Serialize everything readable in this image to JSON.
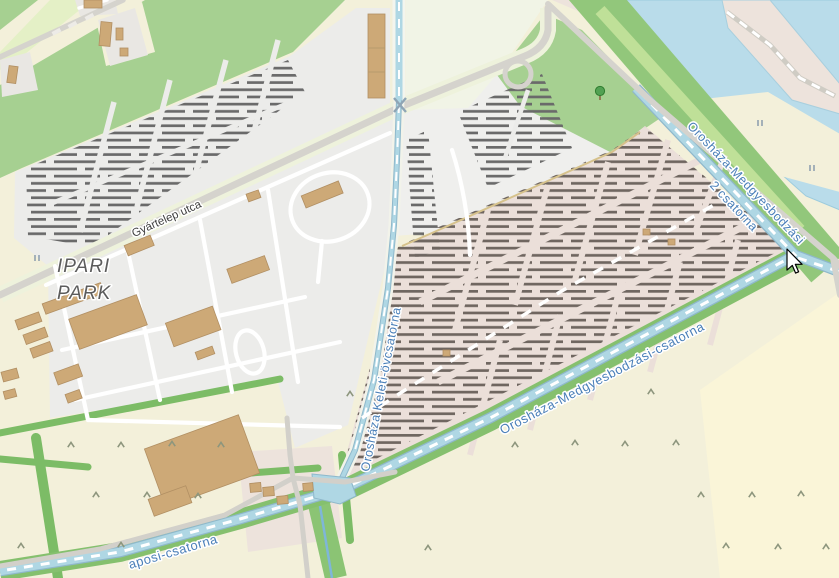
{
  "map": {
    "labels": {
      "place_line1": "IPARI",
      "place_line2": "PARK",
      "street": "Gyártelep utca",
      "canal_keleti": "Orosháza Keleti-övcsatorna",
      "canal_medgyes": "Orosháza-Medgyesbodzási-csatorna",
      "canal_medgyes2_line1": "Orosháza-Medgyesbodzási",
      "canal_medgyes2_line2": "2 csatorna",
      "canal_bottom_left": "aposi-csatorna"
    },
    "icons": {
      "tree": "deciduous-tree-icon",
      "scrub": "scrub-caret-icon",
      "marsh": "marsh-lines-icon",
      "weir": "weir-node-icon",
      "cursor": "mouse-pointer-icon"
    },
    "colors": {
      "farmland": "#F3F0DA",
      "farmland_bright": "#FAF5D8",
      "grass": "#A6D091",
      "band_green": "#92C77B",
      "band_light": "#BFE098",
      "meadow_strip": "#E4F0C6",
      "hedge": "#7CBC66",
      "water": "#B9DCEA",
      "canal": "#AFD7E4",
      "canal_edge": "#8FB8CB",
      "solar_ground": "#ECECEA",
      "whitish": "#EFEFED",
      "pale_e": "#F1F4E6",
      "brownfield": "#EBDFD9",
      "brownfield_light": "#EDE3DC",
      "grey_plot": "#E9E7E3",
      "road": "#D5D3CD",
      "building": "#CDA977",
      "building_edge": "#B18F63",
      "panel_dark": "#6A6A6A",
      "panel_dark_warm": "#6F6660",
      "boundary": "#D6C28C",
      "label_water": "#4A7FB8",
      "label_street": "#3E3E3E",
      "label_place": "#5C5C5C",
      "scrub": "#8D967D",
      "marsh": "#7A8FA6"
    }
  }
}
